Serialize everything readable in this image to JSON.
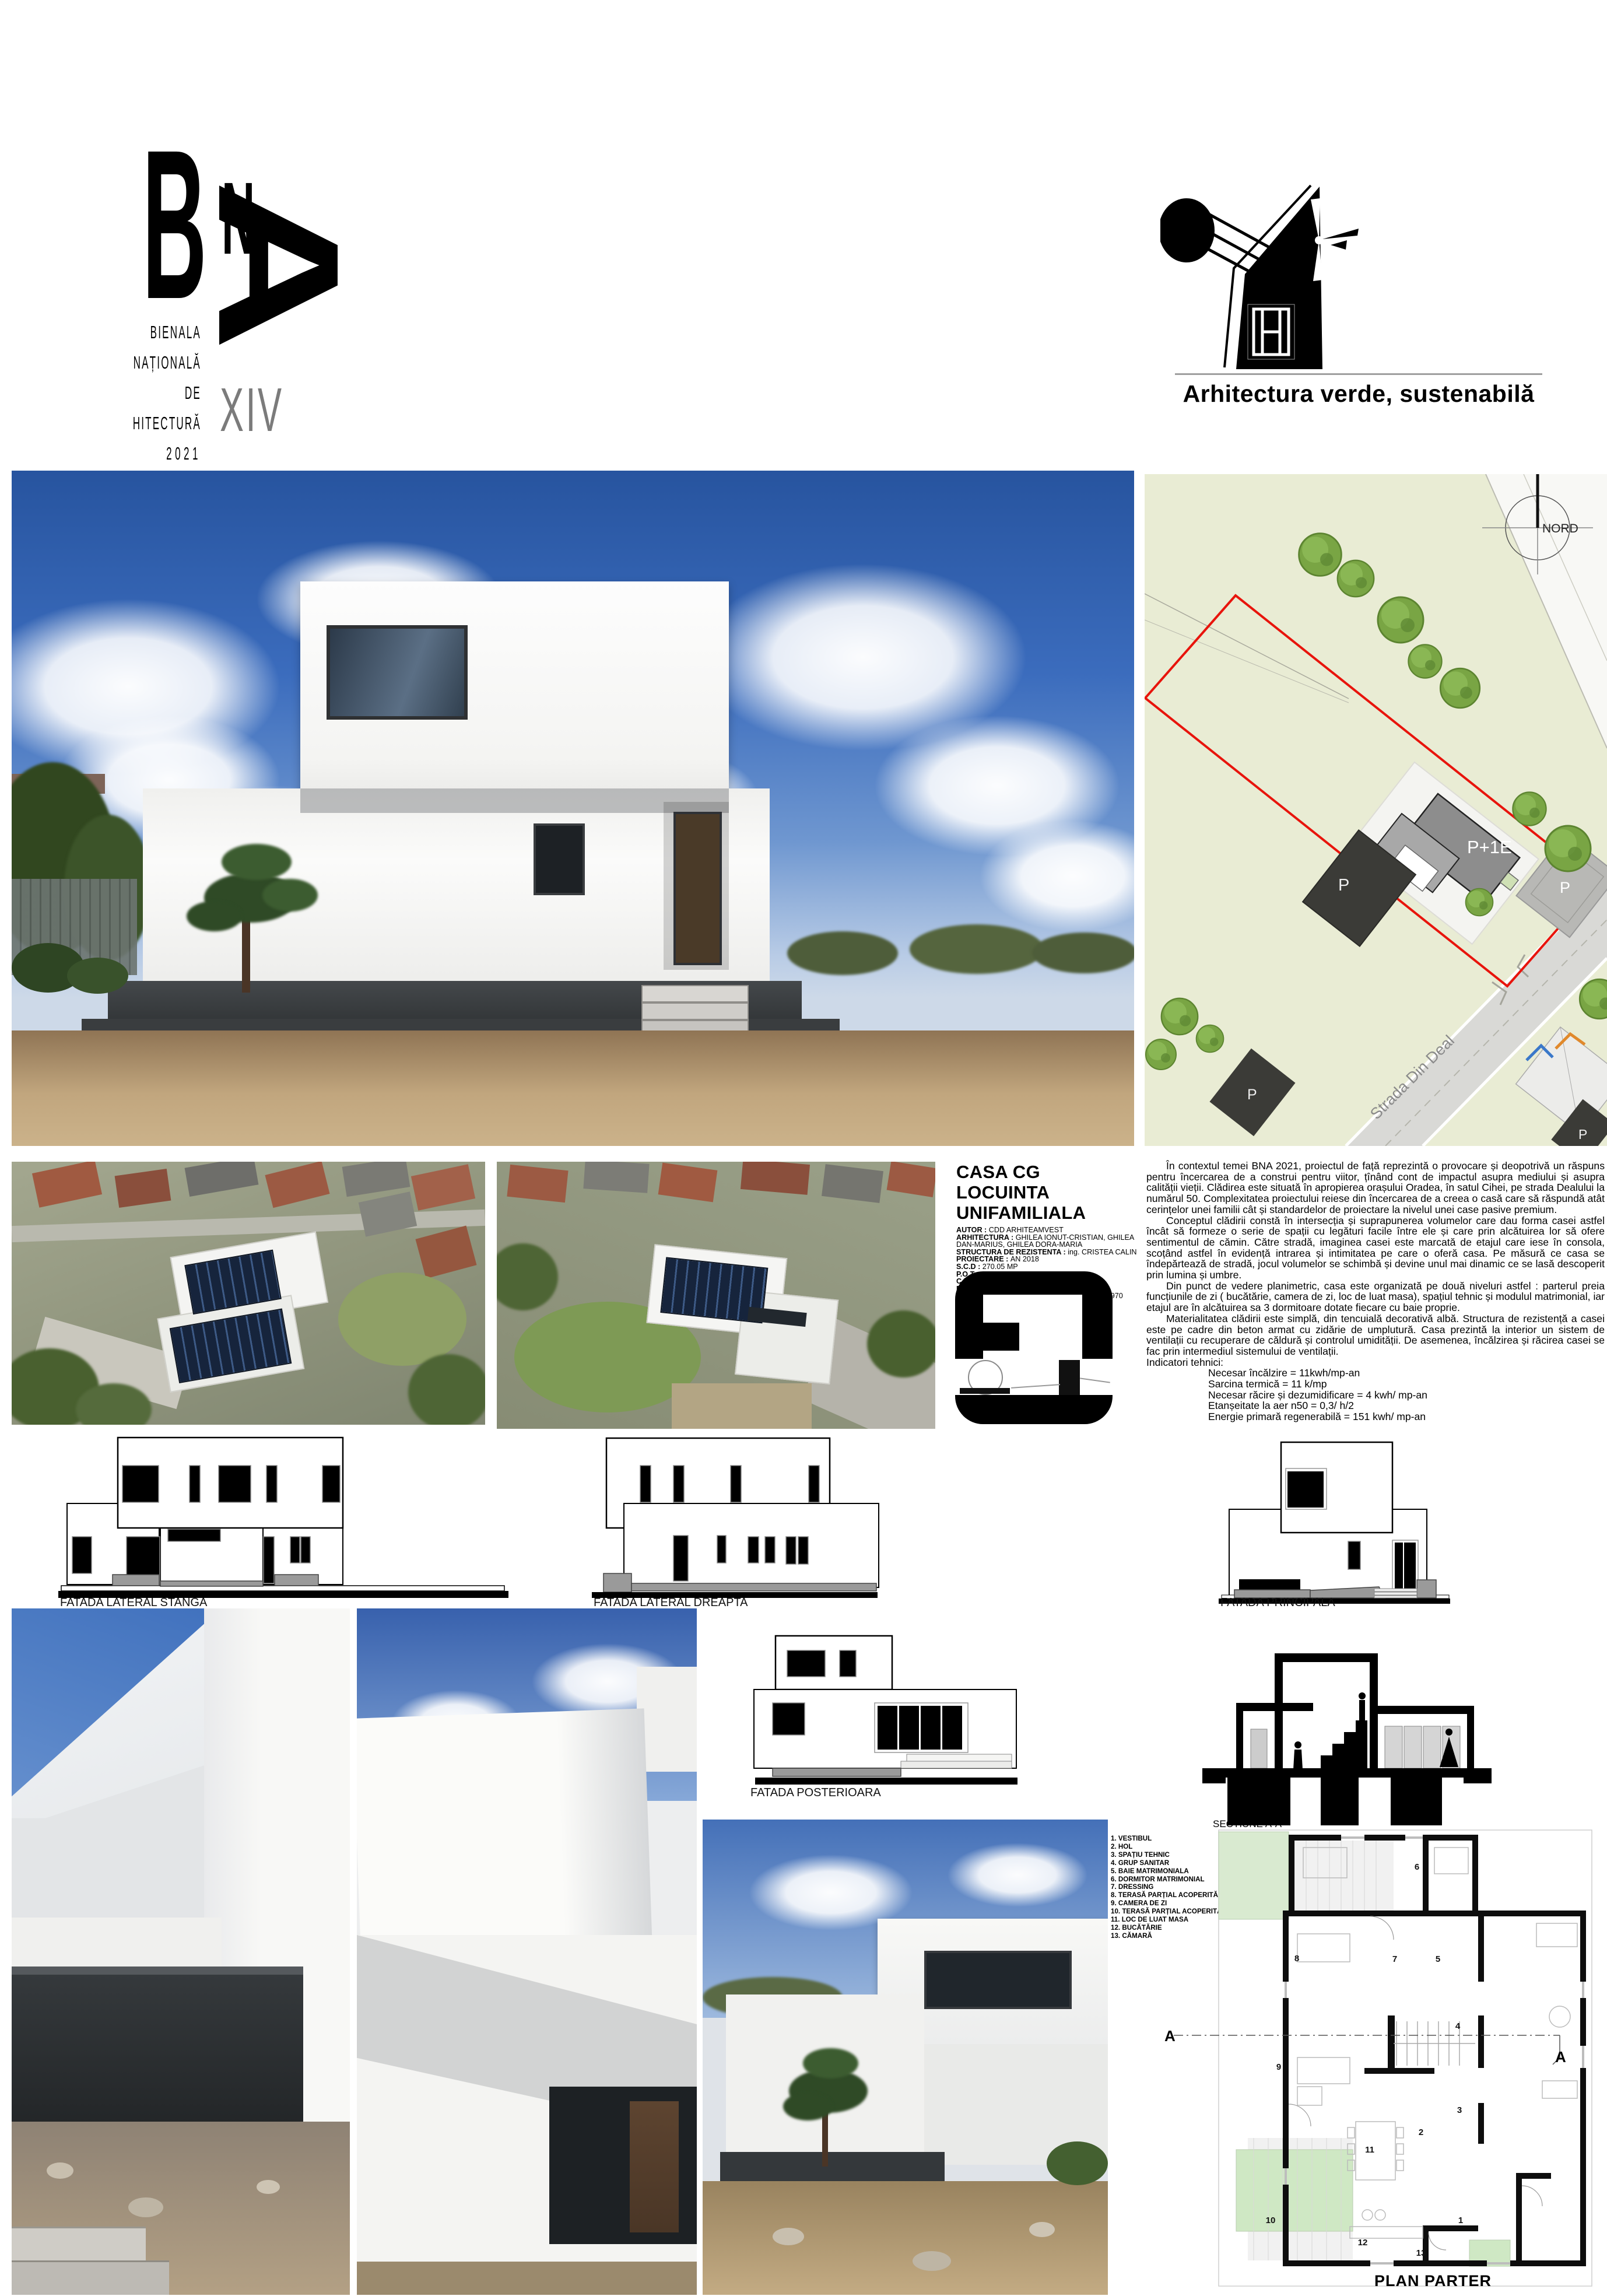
{
  "header": {
    "bna_letters": {
      "b": "B",
      "n": "N",
      "a": "A"
    },
    "bna_lines": [
      "BIENALA",
      "NAȚIONALĂ",
      "DE",
      "ARHITECTURĂ",
      "2021"
    ],
    "edition": "XIV",
    "theme": "Arhitectura verde, sustenabilă"
  },
  "site_plan": {
    "north_label": "NORD",
    "street_label": "Strada Din Deal",
    "house_label": "P+1E",
    "parking_label_1": "P",
    "parking_label_2": "P",
    "parking_label_3": "P",
    "parking_label_4": "P"
  },
  "project": {
    "title_line1": "CASA CG",
    "title_line2": "LOCUINTA UNIFAMILIALA",
    "fields": [
      {
        "label": "AUTOR",
        "value": "CDD ARHITEAMVEST"
      },
      {
        "label": "ARHITECTURA",
        "value": "GHILEA IONUT-CRISTIAN, GHILEA DAN-MARIUS, GHILEA DORA-MARIA"
      },
      {
        "label": "STRUCTURA DE REZISTENTA",
        "value": "ing. CRISTEA CALIN"
      },
      {
        "label": "PROIECTARE",
        "value": "AN 2018"
      },
      {
        "label": "S.C.D",
        "value": "270.05 MP"
      },
      {
        "label": "P.O.T.",
        "value": "15%"
      },
      {
        "label": "C.U.T.",
        "value": "0,22"
      },
      {
        "label": "REGIM DE INALTIME",
        "value": "P+1E"
      },
      {
        "label": "COST MEDIU ESTIMAT CONSTRUCTIE/MP",
        "value": "970 euro"
      }
    ]
  },
  "description": {
    "p1": "În contextul temei BNA 2021, proiectul de față reprezintă o provocare și deopotrivă un răspuns pentru încercarea de a construi pentru viitor, țînând cont de impactul asupra mediului și asupra calității vieții. Clădirea este situată în apropierea orașului Oradea, în satul Cihei, pe strada Dealului la numărul 50. Complexitatea proiectului reiese din încercarea de a creea o casă care să răspundă atât cerințelor unei familii cât și standardelor de proiectare la nivelul unei case pasive premium.",
    "p2": "Conceptul clădirii constă în intersecția și suprapunerea volumelor care dau forma casei astfel încât să formeze o serie de spații cu legături facile între ele și care prin alcătuirea lor să ofere sentimentul de cămin. Către stradă, imaginea casei este marcată de etajul care iese în consola, scoțând astfel în evidență intrarea și intimitatea pe care o oferă casa. Pe măsură ce casa se îndepărtează de stradă, jocul volumelor se schimbă și devine unul mai dinamic ce se lasă descoperit prin lumina și umbre.",
    "p3": "Din punct de vedere planimetric, casa este organizată pe două niveluri astfel : parterul preia funcțiunile de zi ( bucătărie, camera de zi, loc de luat masa), spațiul tehnic și modulul matrimonial, iar etajul are în alcătuirea sa 3 dormitoare dotate fiecare cu baie proprie.",
    "p4": "Materialitatea clădirii este simplă, din tencuială decorativă albă. Structura de rezistență a casei este pe cadre din beton armat cu zidărie de umplutură. Casa prezintă la interior un sistem de ventilații cu recuperare de căldură și controlul umidității. De asemenea, încălzirea și răcirea casei se fac prin intermediul sistemului de ventilații.",
    "indicators_title": "Indicatori tehnici:",
    "indicators": [
      "Necesar încălzire = 11kwh/mp-an",
      "Sarcina termică = 11 k/mp",
      "Necesar răcire și dezumidificare = 4 kwh/ mp-an",
      "Etanșeitate la aer n50 = 0,3/ h/2",
      "Energie primară regenerabilă = 151 kwh/ mp-an"
    ]
  },
  "drawings": {
    "elevation_left_label": "FATADA LATERAL STANGA",
    "elevation_right_label": "FATADA LATERAL DREAPTA",
    "elevation_front_label": "FATADA PRINCIPALA",
    "elevation_back_label": "FATADA POSTERIOARA",
    "section_label": "SECTIUNE A-A",
    "plan_label": "PLAN PARTER",
    "section_marker": "A"
  },
  "floor_plan": {
    "legend": [
      "1. VESTIBUL",
      "2. HOL",
      "3. SPAȚIU TEHNIC",
      "4. GRUP SANITAR",
      "5. BAIE MATRIMONIALA",
      "6. DORMITOR MATRIMONIAL",
      "7. DRESSING",
      "8. TERASĂ PARȚIAL ACOPERITĂ",
      "9. CAMERA DE ZI",
      "10. TERASĂ PARȚIAL ACOPERITĂ",
      "11. LOC DE LUAT MASA",
      "12. BUCĂTĂRIE",
      "13. CĂMARĂ"
    ],
    "room_numbers": [
      "1",
      "2",
      "3",
      "4",
      "5",
      "6",
      "7",
      "8",
      "9",
      "10",
      "11",
      "12",
      "13"
    ]
  },
  "colors": {
    "accent_red": "#e8140c",
    "plan_green": "#d9ead0",
    "sky_blue": "#2f5fb3",
    "edition_gray": "#7b7b7b"
  }
}
